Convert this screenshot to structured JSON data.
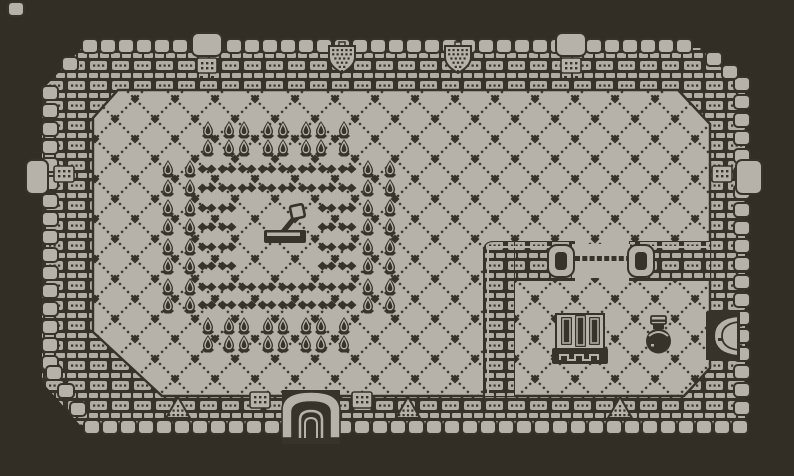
{
  "scene": {
    "name": "monochrome dungeon room map",
    "style": "gameboy-zelda pixel art",
    "description": "Top-down castle room with crenellated outer walls, diamond lattice floor, a field of spike plants and dark chain links surrounding a central floor lever, and a walled side chamber containing a barred shrine, a pot, a side door and a chained wall gap."
  },
  "palette": {
    "background": "#322e26",
    "light": "#b6b2a9",
    "dark": "#37332a"
  },
  "canvas": {
    "width": 794,
    "height": 476
  },
  "layout": {
    "crenellations": {
      "block": {
        "w": 16,
        "h": 14,
        "rx": 4,
        "pitch": 18
      },
      "rows": [
        {
          "name": "top-battlement",
          "axis": "x",
          "fixed": 39,
          "from": 82,
          "count": 34
        },
        {
          "name": "bottom-battlement",
          "axis": "x",
          "fixed": 420,
          "from": 84,
          "count": 37
        },
        {
          "name": "left-battlement",
          "axis": "y",
          "fixed": 42,
          "from": 86,
          "count": 16
        },
        {
          "name": "right-battlement",
          "axis": "y",
          "fixed": 734,
          "from": 77,
          "count": 19
        }
      ],
      "corner_blocks": [
        [
          8,
          2
        ],
        [
          62,
          57
        ],
        [
          706,
          52
        ],
        [
          722,
          65
        ],
        [
          46,
          366
        ],
        [
          58,
          384
        ],
        [
          70,
          402
        ]
      ]
    },
    "wall_outer": [
      [
        82,
        48
      ],
      [
        700,
        48
      ],
      [
        745,
        90
      ],
      [
        745,
        425
      ],
      [
        80,
        425
      ],
      [
        42,
        382
      ],
      [
        42,
        90
      ]
    ],
    "floor": [
      [
        118,
        90
      ],
      [
        678,
        90
      ],
      [
        710,
        124
      ],
      [
        710,
        368
      ],
      [
        684,
        396
      ],
      [
        162,
        396
      ],
      [
        93,
        332
      ],
      [
        93,
        118
      ]
    ],
    "lattice": {
      "tile": 40,
      "offset_x": 15,
      "offset_y": 19
    },
    "inner_walls": {
      "vertical": {
        "x": 484,
        "y": 242,
        "w": 30,
        "h": 154
      },
      "h_seg1": {
        "x": 484,
        "y": 242,
        "w": 90,
        "h": 38
      },
      "h_seg2": {
        "x": 630,
        "y": 242,
        "w": 80,
        "h": 38
      },
      "gap": {
        "x": 572,
        "y": 244,
        "w": 58,
        "h": 34,
        "dot_count": 8,
        "dot_y": 256,
        "dot_x0": 575,
        "dot_pitch": 7.3,
        "dot_size": 5
      },
      "caps": [
        [
          548,
          245
        ],
        [
          628,
          245
        ]
      ]
    },
    "buttresses": {
      "top_x": [
        192,
        556
      ],
      "top_y": 33,
      "left": [
        26,
        160
      ],
      "right": [
        736,
        160
      ]
    },
    "deco_blocks": [
      [
        54,
        166
      ],
      [
        712,
        166
      ],
      [
        250,
        392
      ],
      [
        352,
        392
      ]
    ]
  },
  "spike_field": {
    "spike_count": 64,
    "chain_link_count": 48,
    "rows": [
      {
        "y": 121,
        "spikes": [
          201,
          222,
          237,
          261,
          276,
          299,
          314,
          337
        ],
        "blobs": []
      },
      {
        "y": 139,
        "spikes": [
          201,
          222,
          237,
          261,
          276,
          299,
          314,
          337
        ],
        "blobs": []
      },
      {
        "y": 160,
        "spikes": [
          161,
          183,
          361,
          383
        ],
        "blobs": [
          197,
          217,
          237,
          257,
          277,
          297,
          317,
          337
        ]
      },
      {
        "y": 179,
        "spikes": [
          161,
          183,
          361,
          383
        ],
        "blobs": [
          197,
          217,
          237,
          257,
          277,
          297,
          317,
          337
        ]
      },
      {
        "y": 199,
        "spikes": [
          161,
          183,
          361,
          383
        ],
        "blobs": [
          197,
          217,
          317,
          337
        ]
      },
      {
        "y": 218,
        "spikes": [
          161,
          183,
          361,
          383
        ],
        "blobs": [
          197,
          217,
          317,
          337
        ]
      },
      {
        "y": 238,
        "spikes": [
          161,
          183,
          361,
          383
        ],
        "blobs": [
          197,
          217,
          317,
          337
        ]
      },
      {
        "y": 257,
        "spikes": [
          161,
          183,
          361,
          383
        ],
        "blobs": [
          197,
          217,
          317,
          337
        ]
      },
      {
        "y": 278,
        "spikes": [
          161,
          183,
          361,
          383
        ],
        "blobs": [
          197,
          217,
          237,
          257,
          277,
          297,
          317,
          337
        ]
      },
      {
        "y": 296,
        "spikes": [
          161,
          183,
          361,
          383
        ],
        "blobs": [
          197,
          217,
          237,
          257,
          277,
          297,
          317,
          337
        ]
      },
      {
        "y": 317,
        "spikes": [
          201,
          222,
          237,
          261,
          276,
          299,
          314,
          337
        ],
        "blobs": []
      },
      {
        "y": 335,
        "spikes": [
          201,
          222,
          237,
          261,
          276,
          299,
          314,
          337
        ],
        "blobs": []
      }
    ]
  },
  "objects": {
    "lever": {
      "x": 262,
      "y": 200,
      "label": "floor lever switch"
    },
    "cage": {
      "x": 554,
      "y": 314,
      "label": "barred shrine"
    },
    "pot": {
      "x": 644,
      "y": 316,
      "label": "lidded pot"
    },
    "door_bottom": {
      "x": 274,
      "y": 384,
      "label": "south arched doorway"
    },
    "door_right": {
      "x": 702,
      "y": 310,
      "label": "east round door"
    },
    "shields": {
      "x_list": [
        328,
        444
      ],
      "y": 44,
      "label": "wall shield emblem"
    },
    "pyramids": {
      "list": [
        [
          166,
          397
        ],
        [
          396,
          397
        ],
        [
          608,
          397
        ]
      ],
      "label": "wall pyramid emblem"
    }
  }
}
